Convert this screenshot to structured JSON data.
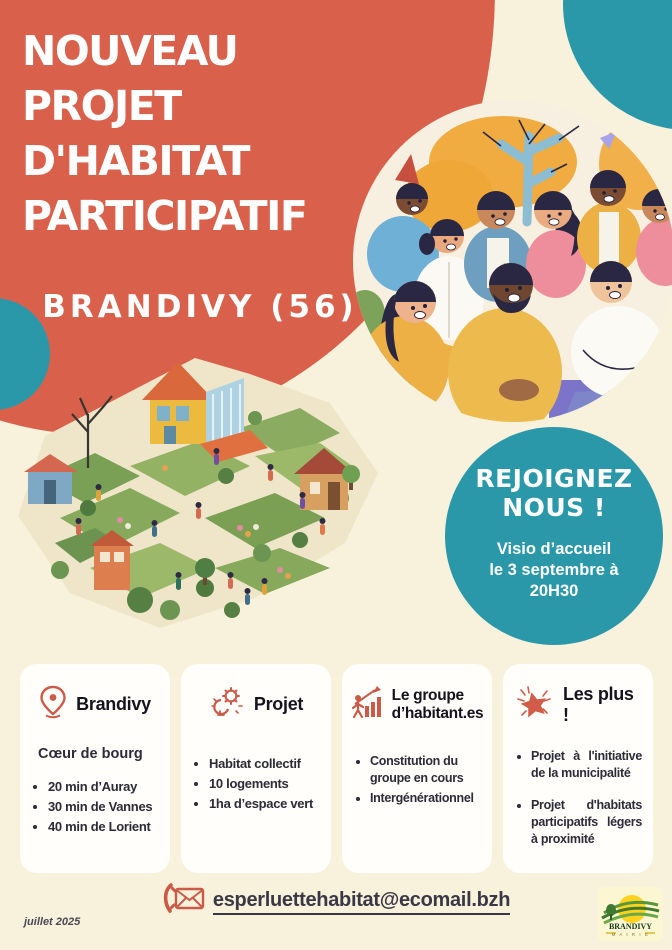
{
  "poster": {
    "title": {
      "lines": [
        "NOUVEAU",
        "PROJET",
        "D'HABITAT",
        "PARTICIPATIF"
      ]
    },
    "location_heading": "BRANDIVY (56)",
    "join": {
      "line1": "REJOIGNEZ",
      "line2": "NOUS !",
      "info1": "Visio d’accueil",
      "info2": "le 3 septembre à",
      "info3": "20H30"
    },
    "cards": [
      {
        "icon": "location-pin-icon",
        "title": "Brandivy",
        "subtitle": "Cœur de bourg",
        "bullets": [
          "20 min d’Auray",
          "30 min de Vannes",
          "40 min de Lorient"
        ]
      },
      {
        "icon": "idea-gear-icon",
        "title": "Projet",
        "bullets": [
          "Habitat collectif",
          "10 logements",
          "1ha d’espace vert"
        ]
      },
      {
        "icon": "growth-chart-icon",
        "title": "Le groupe d’habitant.es",
        "bullets": [
          "Constitution du groupe en cours",
          "Intergénérationnel"
        ]
      },
      {
        "icon": "star-icon",
        "title": "Les plus !",
        "bullets": [
          "Projet à l'initiative de la municipalité",
          "Projet d'habitats participatifs légers à proximité"
        ]
      }
    ],
    "contact_email": "esperluettehabitat@ecomail.bzh",
    "date": "juillet 2025",
    "logo": {
      "title": "BRANDIVY",
      "subtitle": "M A I R I E"
    },
    "illustrations": {
      "people": "community-group-illustration",
      "village": "eco-village-garden-illustration"
    },
    "colors": {
      "terracotta": "#d9614b",
      "teal": "#2b98aa",
      "cream": "#f8f2dc",
      "ink": "#2c2b36",
      "icon_accent": "#cb5b48"
    }
  }
}
